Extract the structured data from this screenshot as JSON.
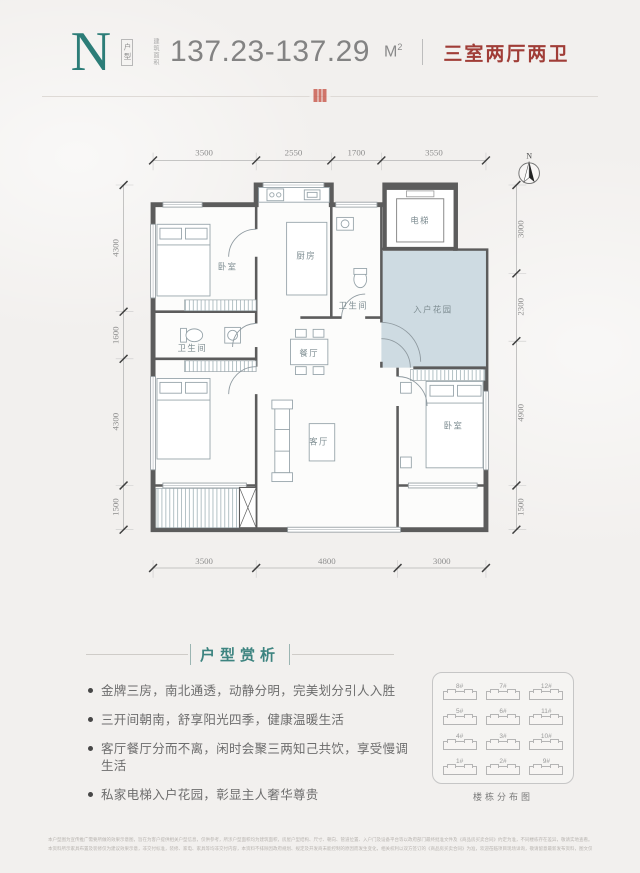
{
  "header": {
    "type_letter": "N",
    "type_label": "户型",
    "area_label": "建筑面积",
    "area_value": "137.23-137.29",
    "area_unit": "M",
    "area_sup": "2",
    "layout_text": "三室两厅两卫"
  },
  "plan": {
    "north_label": "N",
    "dims_top": [
      "3500",
      "2550",
      "1700",
      "3550"
    ],
    "dims_bottom": [
      "3500",
      "4800",
      "3000"
    ],
    "dims_left": [
      "4300",
      "1600",
      "4300",
      "1500"
    ],
    "dims_right": [
      "3000",
      "2300",
      "4900",
      "1500"
    ],
    "rooms": {
      "bedroom_top_left": "卧室",
      "kitchen": "厨房",
      "bath_upper": "卫生间",
      "elevator": "电梯",
      "entry_garden": "入户花园",
      "bath_left": "卫生间",
      "dining": "餐厅",
      "living": "客厅",
      "bedroom_bottom_left": "卧室",
      "bedroom_right": "卧室"
    }
  },
  "analysis": {
    "title": "户型赏析",
    "points": [
      "金牌三房，南北通透，动静分明，完美划分引人入胜",
      "三开间朝南，舒享阳光四季，健康温暖生活",
      "客厅餐厅分而不离，闲时会聚三两知己共饮，享受慢调生活",
      "私家电梯入户花园，彰显主人奢华尊贵"
    ]
  },
  "minimap": {
    "caption": "楼栋分布图",
    "buildings": [
      "8#",
      "7#",
      "12#",
      "5#",
      "6#",
      "11#",
      "4#",
      "3#",
      "10#",
      "1#",
      "2#",
      "9#"
    ]
  },
  "footer": {
    "line1": "本户型图为宣传推广需要所做的效果示意图，旨在为客户提供相关户型信息，仅供参考，所涉户型面积均为建筑面积，房屋户型结构、尺寸、朝向、管道位置、入户门及设备平台等以政府部门最终批准文件及《商品房买卖合同》约定为准，不同楼栋存在差异，敬请实地查看。",
    "line2": "本资料所示家具布置及装修仅为建议效果示意，非交付标准，装修、家电、家具等均非交付内容，本资料不排除因政府规划、规定及开发商未能控制的原因而发生变化，相关权利以双方签订的《商品房买卖合同》为准，欢迎莅临项目现场详询，敬请留意最新发布资料，图文仅供参考，解释权归开发商所有。"
  },
  "colors": {
    "accent_teal": "#2c7d78",
    "accent_red": "#a03d37",
    "wall": "#5c5c5c",
    "garden_fill": "#cedbe2"
  }
}
